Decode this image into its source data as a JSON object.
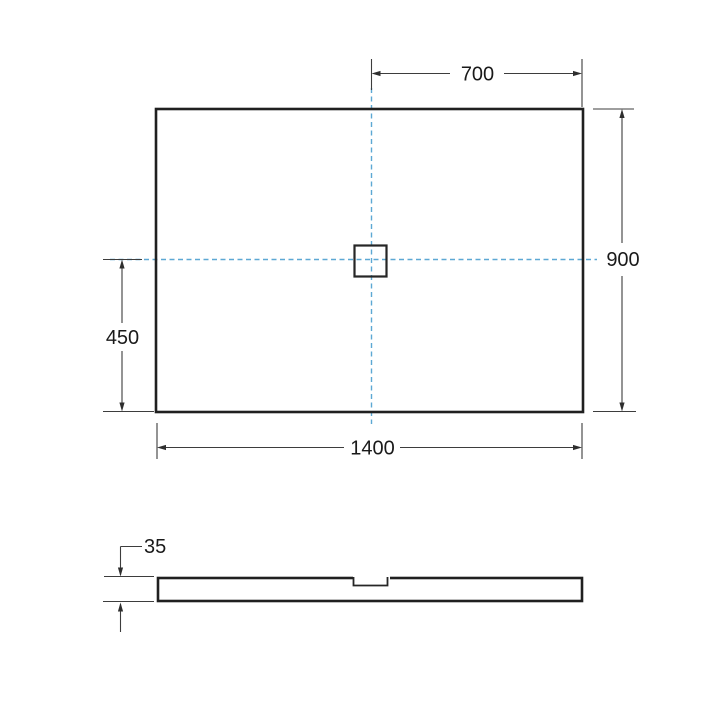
{
  "colors": {
    "outline": "#202020",
    "dimension_line": "#3d3d3d",
    "centerline": "#5da8d4",
    "background": "#ffffff"
  },
  "dimensions": {
    "center_to_right_edge": "700",
    "overall_depth": "900",
    "center_to_bottom_edge": "450",
    "overall_width": "1400",
    "tray_thickness": "35"
  }
}
